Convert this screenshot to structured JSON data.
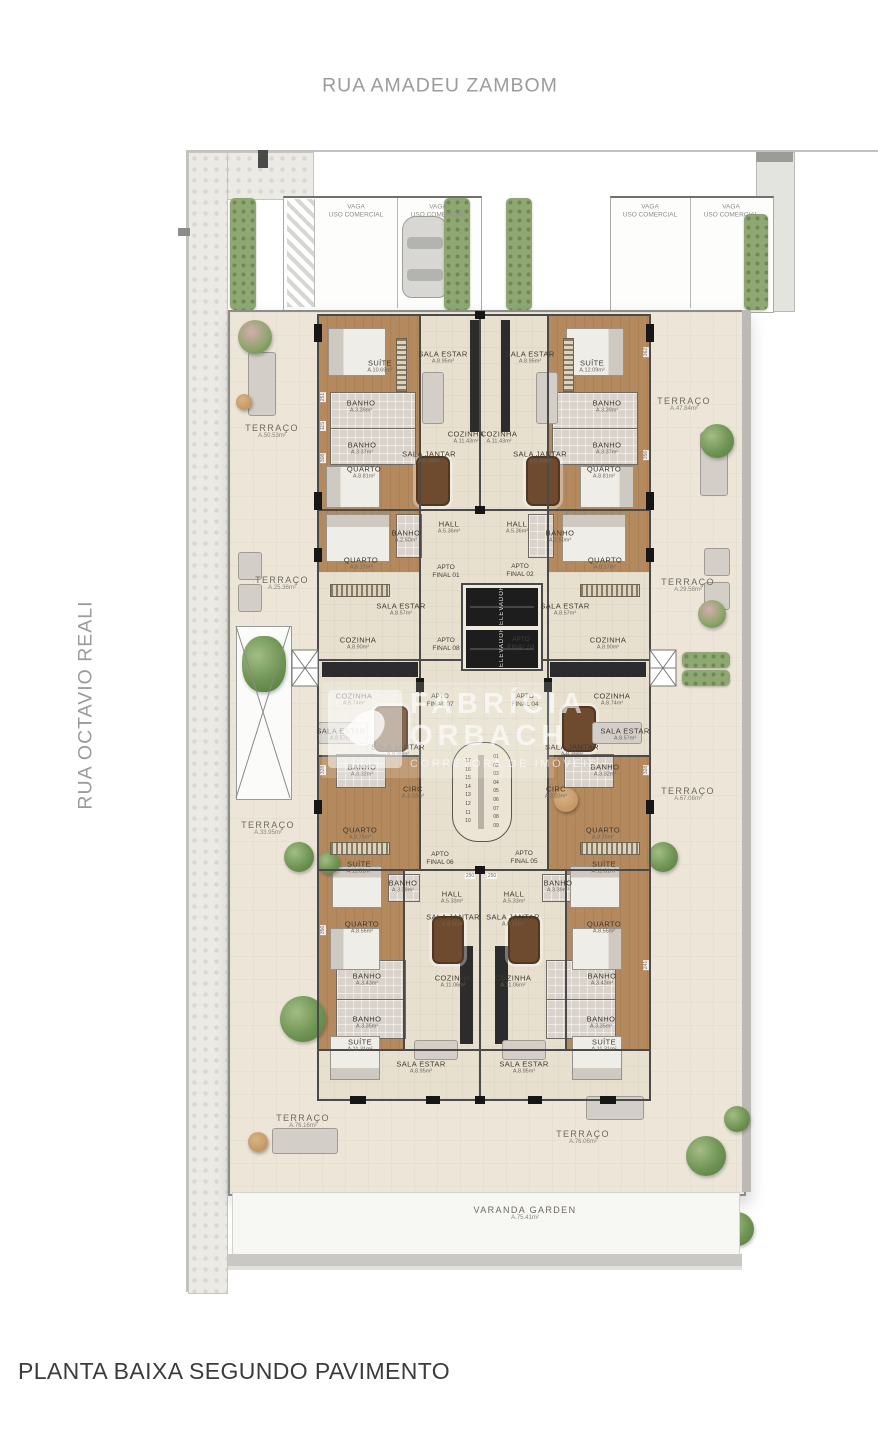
{
  "streets": {
    "top": "RUA AMADEU ZAMBOM",
    "left": "RUA OCTAVIO REALI"
  },
  "title": "PLANTA BAIXA SEGUNDO PAVIMENTO",
  "watermark": {
    "line1": "FABRÍCIA",
    "line2": "ORBACH",
    "tagline": "CORRETORA DE IMÓVEIS"
  },
  "elevator_label": "ELEVADOR",
  "stairs": {
    "left": [
      "17",
      "16",
      "15",
      "14",
      "13",
      "12",
      "11",
      "10"
    ],
    "right": [
      "01",
      "02",
      "03",
      "04",
      "05",
      "06",
      "07",
      "08",
      "09"
    ]
  },
  "varanda": {
    "name": "VARANDA GARDEN",
    "area": "A.75.41m²"
  },
  "parking": [
    {
      "l1": "VAGA",
      "l2": "USO COMERCIAL",
      "x": 356,
      "y": 212
    },
    {
      "l1": "VAGA",
      "l2": "USO COMERCIAL",
      "x": 438,
      "y": 212
    },
    {
      "l1": "VAGA",
      "l2": "USO COMERCIAL",
      "x": 650,
      "y": 212
    },
    {
      "l1": "VAGA",
      "l2": "USO COMERCIAL",
      "x": 731,
      "y": 212
    }
  ],
  "apartments": [
    {
      "l1": "APTO",
      "l2": "FINAL 01",
      "x": 446,
      "y": 572
    },
    {
      "l1": "APTO",
      "l2": "FINAL 02",
      "x": 520,
      "y": 571
    },
    {
      "l1": "APTO",
      "l2": "FINAL 08",
      "x": 446,
      "y": 645
    },
    {
      "l1": "APTO",
      "l2": "FINAL 03",
      "x": 521,
      "y": 644
    },
    {
      "l1": "APTO",
      "l2": "FINAL 07",
      "x": 440,
      "y": 701
    },
    {
      "l1": "APTO",
      "l2": "FINAL 04",
      "x": 525,
      "y": 701
    },
    {
      "l1": "APTO",
      "l2": "FINAL 06",
      "x": 440,
      "y": 859
    },
    {
      "l1": "APTO",
      "l2": "FINAL 05",
      "x": 524,
      "y": 858
    }
  ],
  "terraces": [
    {
      "name": "TERRAÇO",
      "area": "A.50.53m²",
      "x": 272,
      "y": 431
    },
    {
      "name": "TERRAÇO",
      "area": "A.47.84m²",
      "x": 684,
      "y": 404
    },
    {
      "name": "TERRAÇO",
      "area": "A.25.36m²",
      "x": 282,
      "y": 583
    },
    {
      "name": "TERRAÇO",
      "area": "A.29.58m²",
      "x": 688,
      "y": 585
    },
    {
      "name": "TERRAÇO",
      "area": "A.33.95m²",
      "x": 268,
      "y": 828
    },
    {
      "name": "TERRAÇO",
      "area": "A.67.08m²",
      "x": 688,
      "y": 794
    },
    {
      "name": "TERRAÇO",
      "area": "A.76.16m²",
      "x": 303,
      "y": 1121
    },
    {
      "name": "TERRAÇO",
      "area": "A.76.06m²",
      "x": 583,
      "y": 1137
    }
  ],
  "rooms": [
    {
      "name": "SUÍTE",
      "area": "A.10.69m²",
      "x": 380,
      "y": 366
    },
    {
      "name": "SALA ESTAR",
      "area": "A.8.95m²",
      "x": 443,
      "y": 357
    },
    {
      "name": "SALA ESTAR",
      "area": "A.8.95m²",
      "x": 530,
      "y": 357
    },
    {
      "name": "SUÍTE",
      "area": "A.12.09m²",
      "x": 592,
      "y": 366
    },
    {
      "name": "BANHO",
      "area": "A.3.39m²",
      "x": 361,
      "y": 406
    },
    {
      "name": "BANHO",
      "area": "A.3.39m²",
      "x": 607,
      "y": 406
    },
    {
      "name": "COZINHA",
      "area": "A.11.43m²",
      "x": 466,
      "y": 437
    },
    {
      "name": "COZINHA",
      "area": "A.11.43m²",
      "x": 499,
      "y": 437
    },
    {
      "name": "BANHO",
      "area": "A.3.37m²",
      "x": 362,
      "y": 448
    },
    {
      "name": "BANHO",
      "area": "A.3.37m²",
      "x": 607,
      "y": 448
    },
    {
      "name": "SALA JANTAR",
      "area": "A.8.39m²",
      "x": 429,
      "y": 457
    },
    {
      "name": "SALA JANTAR",
      "area": "A.8.39m²",
      "x": 540,
      "y": 457
    },
    {
      "name": "QUARTO",
      "area": "A.8.81m²",
      "x": 364,
      "y": 472
    },
    {
      "name": "QUARTO",
      "area": "A.8.81m²",
      "x": 604,
      "y": 472
    },
    {
      "name": "HALL",
      "area": "A.5.36m²",
      "x": 449,
      "y": 527
    },
    {
      "name": "HALL",
      "area": "A.5.36m²",
      "x": 517,
      "y": 527
    },
    {
      "name": "BANHO",
      "area": "A.2.50m²",
      "x": 406,
      "y": 536
    },
    {
      "name": "BANHO",
      "area": "A.2.50m²",
      "x": 560,
      "y": 536
    },
    {
      "name": "QUARTO",
      "area": "A.8.17m²",
      "x": 361,
      "y": 563
    },
    {
      "name": "QUARTO",
      "area": "A.8.17m²",
      "x": 605,
      "y": 563
    },
    {
      "name": "SALA ESTAR",
      "area": "A.8.57m²",
      "x": 401,
      "y": 609
    },
    {
      "name": "SALA ESTAR",
      "area": "A.8.57m²",
      "x": 565,
      "y": 609
    },
    {
      "name": "COZINHA",
      "area": "A.8.90m²",
      "x": 358,
      "y": 643
    },
    {
      "name": "COZINHA",
      "area": "A.8.90m²",
      "x": 608,
      "y": 643
    },
    {
      "name": "COZINHA",
      "area": "A.8.74m²",
      "x": 354,
      "y": 699
    },
    {
      "name": "COZINHA",
      "area": "A.8.74m²",
      "x": 612,
      "y": 699
    },
    {
      "name": "SALA ESTAR",
      "area": "A.8.57m²",
      "x": 341,
      "y": 734
    },
    {
      "name": "SALA ESTAR",
      "area": "A.8.57m²",
      "x": 625,
      "y": 734
    },
    {
      "name": "SALA JANTAR",
      "area": "A.8.39m²",
      "x": 398,
      "y": 750
    },
    {
      "name": "SALA JANTAR",
      "area": "A.8.39m²",
      "x": 572,
      "y": 750
    },
    {
      "name": "BANHO",
      "area": "A.3.32m²",
      "x": 362,
      "y": 770
    },
    {
      "name": "BANHO",
      "area": "A.3.32m²",
      "x": 605,
      "y": 770
    },
    {
      "name": "CIRC",
      "area": "A.3.03m²",
      "x": 413,
      "y": 792
    },
    {
      "name": "CIRC",
      "area": "A.3.03m²",
      "x": 556,
      "y": 792
    },
    {
      "name": "QUARTO",
      "area": "A.8.75m²",
      "x": 360,
      "y": 833
    },
    {
      "name": "QUARTO",
      "area": "A.8.75m²",
      "x": 603,
      "y": 833
    },
    {
      "name": "SUÍTE",
      "area": "A.11.31m²",
      "x": 359,
      "y": 867
    },
    {
      "name": "SUÍTE",
      "area": "A.11.31m²",
      "x": 604,
      "y": 867
    },
    {
      "name": "BANHO",
      "area": "A.3.39m²",
      "x": 403,
      "y": 886
    },
    {
      "name": "BANHO",
      "area": "A.3.39m²",
      "x": 558,
      "y": 886
    },
    {
      "name": "HALL",
      "area": "A.5.33m²",
      "x": 452,
      "y": 897
    },
    {
      "name": "HALL",
      "area": "A.5.33m²",
      "x": 514,
      "y": 897
    },
    {
      "name": "SALA JANTAR",
      "area": "A.8.16m²",
      "x": 453,
      "y": 920
    },
    {
      "name": "SALA JANTAR",
      "area": "A.8.16m²",
      "x": 513,
      "y": 920
    },
    {
      "name": "QUARTO",
      "area": "A.8.56m²",
      "x": 362,
      "y": 927
    },
    {
      "name": "QUARTO",
      "area": "A.8.56m²",
      "x": 604,
      "y": 927
    },
    {
      "name": "BANHO",
      "area": "A.3.43m²",
      "x": 367,
      "y": 979
    },
    {
      "name": "BANHO",
      "area": "A.3.43m²",
      "x": 602,
      "y": 979
    },
    {
      "name": "COZINHA",
      "area": "A.11.06m²",
      "x": 453,
      "y": 981
    },
    {
      "name": "COZINHA",
      "area": "A.11.06m²",
      "x": 513,
      "y": 981
    },
    {
      "name": "BANHO",
      "area": "A.3.35m²",
      "x": 367,
      "y": 1022
    },
    {
      "name": "BANHO",
      "area": "A.3.35m²",
      "x": 601,
      "y": 1022
    },
    {
      "name": "SUÍTE",
      "area": "A.11.31m²",
      "x": 360,
      "y": 1045
    },
    {
      "name": "SUÍTE",
      "area": "A.11.31m²",
      "x": 604,
      "y": 1045
    },
    {
      "name": "SALA ESTAR",
      "area": "A.8.95m²",
      "x": 421,
      "y": 1067
    },
    {
      "name": "SALA ESTAR",
      "area": "A.8.95m²",
      "x": 524,
      "y": 1067
    }
  ],
  "dims": [
    {
      "v": "251",
      "x": 323,
      "y": 397,
      "r": true
    },
    {
      "v": "115",
      "x": 323,
      "y": 426,
      "r": true
    },
    {
      "v": "308",
      "x": 323,
      "y": 458,
      "r": true
    },
    {
      "v": "362",
      "x": 646,
      "y": 352,
      "r": true
    },
    {
      "v": "356",
      "x": 646,
      "y": 455,
      "r": true
    },
    {
      "v": "328",
      "x": 323,
      "y": 770,
      "r": true
    },
    {
      "v": "328",
      "x": 646,
      "y": 770,
      "r": true
    },
    {
      "v": "356",
      "x": 323,
      "y": 930,
      "r": true
    },
    {
      "v": "241",
      "x": 646,
      "y": 965,
      "r": true
    },
    {
      "v": "250",
      "x": 470,
      "y": 876
    },
    {
      "v": "250",
      "x": 492,
      "y": 876
    }
  ],
  "colors": {
    "street_text": "#9b9b9b",
    "title_text": "#3b3b3b",
    "terrace_floor": "#ece5d8",
    "tile_floor": "#e8e0cf",
    "wood_floor": "#b4895e",
    "bath_floor": "#d9d3cc",
    "wall": "#4a4a4a",
    "hedge": "#8fa873",
    "counter": "#2c2c2c",
    "watermark": "rgba(255,255,255,0.62)"
  }
}
